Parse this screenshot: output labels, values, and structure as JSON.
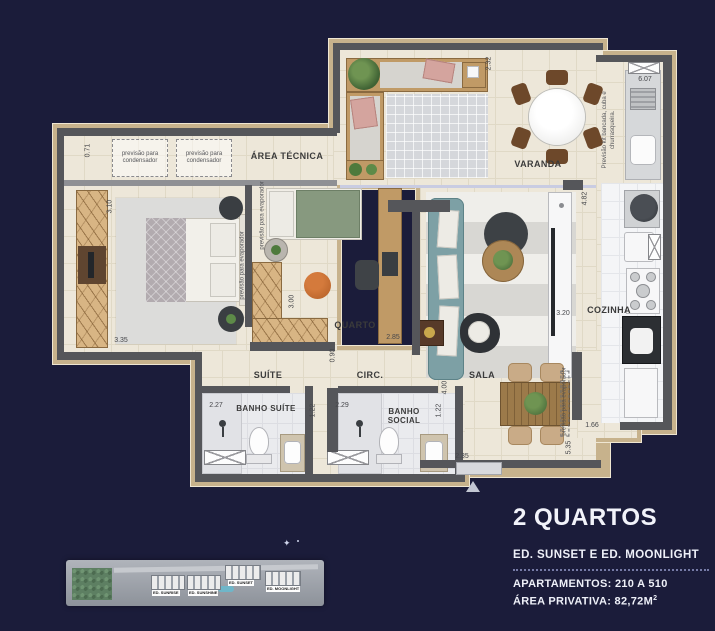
{
  "info": {
    "title": "2 QUARTOS",
    "subtitle": "ED. SUNSET E ED. MOONLIGHT",
    "apartments": "APARTAMENTOS: 210 A 510",
    "private_area_label": "ÁREA PRIVATIVA: 82,72M",
    "private_area_sup": "2"
  },
  "plan": {
    "rooms": {
      "area_tecnica": "ÁREA TÉCNICA",
      "varanda": "VARANDA",
      "quarto": "QUARTO",
      "suite": "SUÍTE",
      "circ": "CIRC.",
      "banho_suite": "BANHO SUÍTE",
      "banho_social": "BANHO SOCIAL",
      "sala": "SALA",
      "cozinha": "COZINHA"
    },
    "annotations": {
      "condensador": "previsão para condensador",
      "kit_bancada": "Previsão kit bancada, cuba e churrasqueira.",
      "evaporador": "previsão para evaporador"
    },
    "dimensions": {
      "v071": "0.71",
      "v310": "3.10",
      "v335": "3.35",
      "v232": "2.32",
      "v607": "6.07",
      "v482": "4.82",
      "v320": "3.20",
      "v300": "3.00",
      "v285": "2.85",
      "v090": "0.90",
      "v227": "2.27",
      "v122": "1.22",
      "v229": "2.29",
      "v400": "4.00",
      "v166": "1.66",
      "v535": "5.35",
      "v235": "2.35"
    }
  },
  "siteplan": {
    "buildings": [
      "ED. SUNRISE",
      "ED. SUNSHINE",
      "ED. SUNSET",
      "ED. MOONLIGHT"
    ]
  },
  "colors": {
    "background": "#1b1c3a",
    "floor": "#ede7d9",
    "wall": "#55565a",
    "outline": "#c7b28c",
    "wood": "#c09a66",
    "sofa": "#7da0a5"
  }
}
